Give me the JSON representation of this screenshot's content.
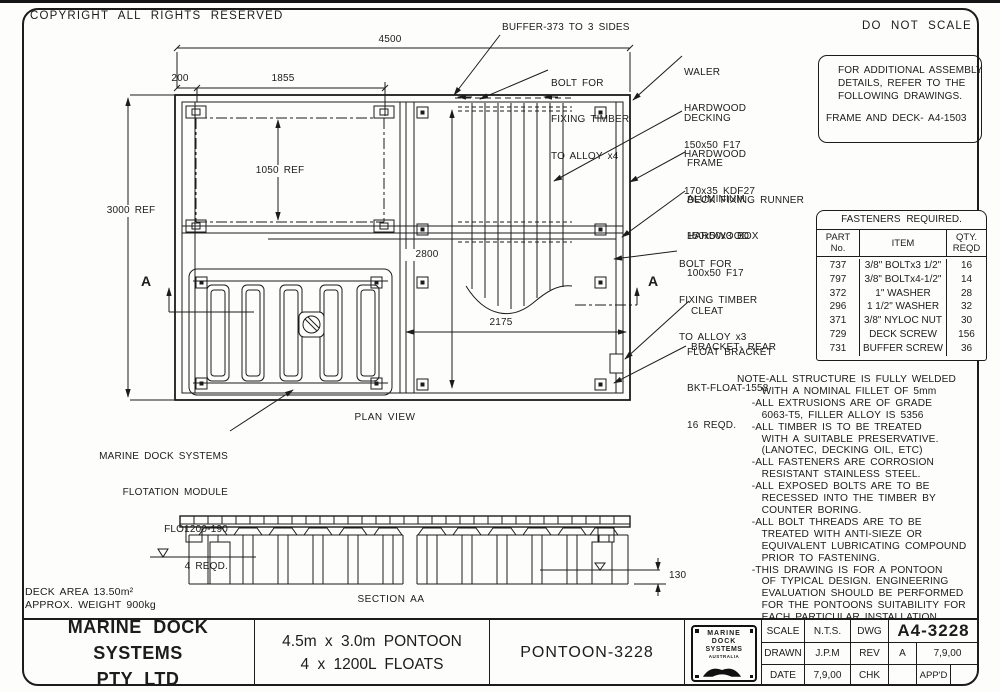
{
  "colors": {
    "ink": "#1c1c1c",
    "paper": "#fdfdfb"
  },
  "header": {
    "copyright": "COPYRIGHT ALL RIGHTS RESERVED",
    "do_not_scale": "DO NOT SCALE"
  },
  "assembly_box": {
    "line1": "FOR ADDITIONAL ASSEMBLY",
    "line2": "DETAILS, REFER TO THE",
    "line3": "FOLLOWING DRAWINGS.",
    "ref": "FRAME AND DECK- A4-1503"
  },
  "fasteners": {
    "title": "FASTENERS REQUIRED.",
    "headers": {
      "part1": "PART",
      "part2": "No.",
      "item": "ITEM",
      "qty1": "QTY.",
      "qty2": "REQD"
    },
    "rows": [
      {
        "part": "737",
        "item": "3/8\" BOLTx3 1/2\"",
        "qty": "16"
      },
      {
        "part": "797",
        "item": "3/8\" BOLTx4-1/2\"",
        "qty": "14"
      },
      {
        "part": "372",
        "item": "1\" WASHER",
        "qty": "28"
      },
      {
        "part": "296",
        "item": "1 1/2\" WASHER",
        "qty": "32"
      },
      {
        "part": "371",
        "item": "3/8\" NYLOC NUT",
        "qty": "30"
      },
      {
        "part": "729",
        "item": "DECK SCREW",
        "qty": "156"
      },
      {
        "part": "731",
        "item": "BUFFER SCREW",
        "qty": "36"
      }
    ]
  },
  "notes": {
    "lines": [
      "NOTE-ALL STRUCTURE IS FULLY WELDED",
      "     WITH A NOMINAL FILLET OF 5mm",
      "   -ALL EXTRUSIONS ARE OF GRADE",
      "     6063-T5, FILLER ALLOY IS 5356",
      "   -ALL TIMBER IS TO BE TREATED",
      "     WITH A SUITABLE PRESERVATIVE.",
      "     (LANOTEC, DECKING OIL, ETC)",
      "   -ALL FASTENERS ARE CORROSION",
      "     RESISTANT STAINLESS STEEL.",
      "   -ALL EXPOSED BOLTS ARE TO BE",
      "     RECESSED INTO THE TIMBER BY",
      "     COUNTER BORING.",
      "   -ALL BOLT THREADS ARE TO BE",
      "     TREATED WITH ANTI-SIEZE OR",
      "     EQUIVALENT LUBRICATING COMPOUND",
      "     PRIOR TO FASTENING.",
      "   -THIS DRAWING IS FOR A PONTOON",
      "     OF TYPICAL DESIGN. ENGINEERING",
      "     EVALUATION SHOULD BE PERFORMED",
      "     FOR THE PONTOONS SUITABILITY FOR",
      "     EACH PARTICULAR INSTALLATION."
    ]
  },
  "callouts": {
    "buffer": "BUFFER-373 TO 3 SIDES",
    "bolt_alloy4": [
      "BOLT FOR",
      "FIXING TIMBER",
      "TO ALLOY x4"
    ],
    "waler": [
      "WALER",
      "HARDWOOD",
      "150x50 F17"
    ],
    "decking": [
      "DECKING",
      "HARDWOOD",
      "170x35 KDF27"
    ],
    "frame": [
      "FRAME",
      "ALUMINIUM",
      "150x50x3 BOX"
    ],
    "deck_runner": [
      "DECK FIXING RUNNER",
      "HARDWOOD",
      "100x50 F17"
    ],
    "bolt_alloy3": [
      "BOLT FOR",
      "FIXING TIMBER",
      "TO ALLOY x3"
    ],
    "cleat": [
      "CLEAT",
      "BRACKET- REAR"
    ],
    "float_bracket": [
      "FLOAT BRACKET",
      "BKT-FLOAT-1558",
      "16 REQD."
    ],
    "flotation_module": [
      "MARINE DOCK SYSTEMS",
      "FLOTATION MODULE",
      "FLO1200-190",
      "4 REQD."
    ]
  },
  "dims": {
    "overall_width": "4500",
    "edge_offset": "200",
    "module_width": "1855",
    "module_height": "1050 REF",
    "overall_height": "3000 REF",
    "deck_length": "2800",
    "bay_width": "2175",
    "freeboard": "130"
  },
  "views": {
    "plan": "PLAN VIEW",
    "section": "SECTION AA",
    "section_marker_left": "A",
    "section_marker_right": "A"
  },
  "stats": {
    "deck_area": "DECK AREA 13.50m²",
    "weight": "APPROX. WEIGHT 900kg"
  },
  "title_block": {
    "company_line1": "MARINE DOCK SYSTEMS",
    "company_line2": "PTY LTD",
    "product_line1": "4.5m x 3.0m PONTOON",
    "product_line2": "4 x 1200L FLOATS",
    "drawing_name": "PONTOON-3228",
    "logo": {
      "line1": "MARINE",
      "line2": "DOCK",
      "line3": "SYSTEMS",
      "line4": "AUSTRALIA"
    },
    "scale_label": "SCALE",
    "scale_value": "N.T.S.",
    "drawn_label": "DRAWN",
    "drawn_value": "J.P.M",
    "date_label": "DATE",
    "date_value": "7,9,00",
    "dwg_label": "DWG",
    "dwg_value": "A4-3228",
    "rev_label": "REV",
    "rev_value": "A",
    "rev_date": "7,9,00",
    "chk_label": "CHK",
    "chk_value": "",
    "appd_label": "APP'D",
    "appd_value": ""
  }
}
